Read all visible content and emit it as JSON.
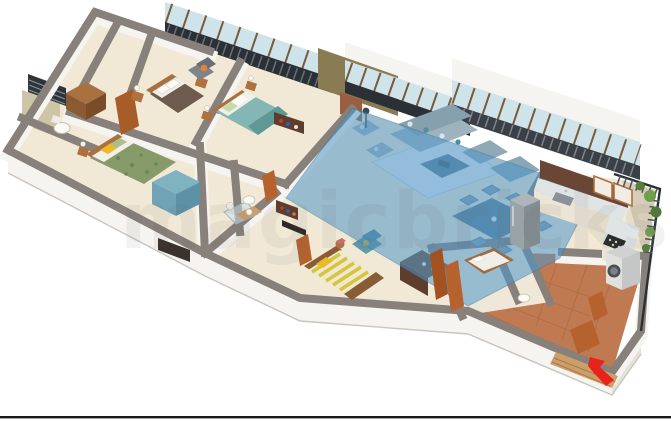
{
  "scene": {
    "type": "3d-isometric-floor-plan",
    "description": "3D isometric cutaway render of a multi-bedroom apartment, living and dining zone highlighted in translucent blue",
    "watermark": {
      "text": "magicbricks",
      "opacity": "0.07"
    },
    "entrance": {
      "marker": "red-arrow",
      "direction": "up-left into entrance door"
    }
  },
  "palette": {
    "background": "#ffffff",
    "bottom_rule": "#1a1a1a",
    "wall_top": "#88807a",
    "wall_face": "#f6f4f0",
    "floor_cream": "#f1e9d6",
    "floor_terracotta": "#c07a52",
    "tile_grout": "#a45f3b",
    "highlight_blue": "#4e96c8",
    "glass": "#cfe3eb",
    "window_frame": "#8a5c33",
    "railing_dark": "#2b3036",
    "wood": "#b0713e",
    "wood_dark": "#6e4a2c",
    "door_wood": "#b5622f",
    "olive_wall": "#8a7c52",
    "mosaic_wall": "#cdc5a5",
    "bed1_blanket": "#6e5b50",
    "bed2_blanket": "#84b7b4",
    "bed3_blanket": "#879a6a",
    "bed4_stripe": "#d8c53e",
    "pillow_yellow": "#ecb92c",
    "accent_orange": "#e5813d",
    "armchair_gray": "#7d848a",
    "sofa_blue": "#9db4bf",
    "table_blue": "#5b7e94",
    "appliance_gray": "#9aa3a8",
    "white_goods": "#e0e0dd",
    "greenery": "#557f3a",
    "arrow_red": "#e8231a"
  },
  "rooms": [
    {
      "id": "bathroom-1",
      "label": "Bathroom 1",
      "features": [
        "toilet",
        "mosaic tiled wall",
        "ventilation window"
      ]
    },
    {
      "id": "dressing-area",
      "label": "Dressing area",
      "features": [
        "wooden wardrobe",
        "wood panel door"
      ]
    },
    {
      "id": "master-bedroom",
      "label": "Master bedroom",
      "features": [
        "double bed with brown duvet",
        "bedside tables with lamps",
        "grey armchair with orange cushion",
        "balcony railing windows"
      ]
    },
    {
      "id": "bedroom-2",
      "label": "Bedroom 2",
      "features": [
        "double bed with teal duvet",
        "sliding glass windows",
        "olive accent wall",
        "brick accent column"
      ]
    },
    {
      "id": "bedroom-3",
      "label": "Bedroom 3",
      "features": [
        "double bed with green patterned duvet",
        "yellow pillow",
        "teal wardrobe",
        "dark media unit"
      ]
    },
    {
      "id": "bathroom-2",
      "label": "Bathroom 2",
      "features": [
        "toilet",
        "washbasin vanity",
        "shower cubicle"
      ]
    },
    {
      "id": "bedroom-4",
      "label": "Bedroom 4",
      "features": [
        "bed with yellow striped cover",
        "teal accent chair",
        "dark wood sideboard with decor"
      ]
    },
    {
      "id": "living-dining",
      "label": "Living and dining",
      "highlighted": true,
      "features": [
        "L-shaped sofa",
        "two armchairs",
        "coffee table",
        "rug",
        "six seat dining table",
        "full height window wall"
      ]
    },
    {
      "id": "kitchen",
      "label": "Kitchen",
      "features": [
        "L-shaped counter",
        "sink",
        "hob",
        "refrigerator",
        "overhead cabinets",
        "dark backsplash"
      ]
    },
    {
      "id": "utility-balcony",
      "label": "Utility balcony",
      "features": [
        "washing machine",
        "terracotta floor tiles",
        "railing",
        "plants"
      ]
    },
    {
      "id": "servant-room",
      "label": "Servant room",
      "features": [
        "single bed",
        "small toilet",
        "wooden doors"
      ]
    },
    {
      "id": "entrance-foyer",
      "label": "Entrance",
      "features": [
        "wooden door",
        "steps",
        "red direction arrow"
      ]
    }
  ]
}
